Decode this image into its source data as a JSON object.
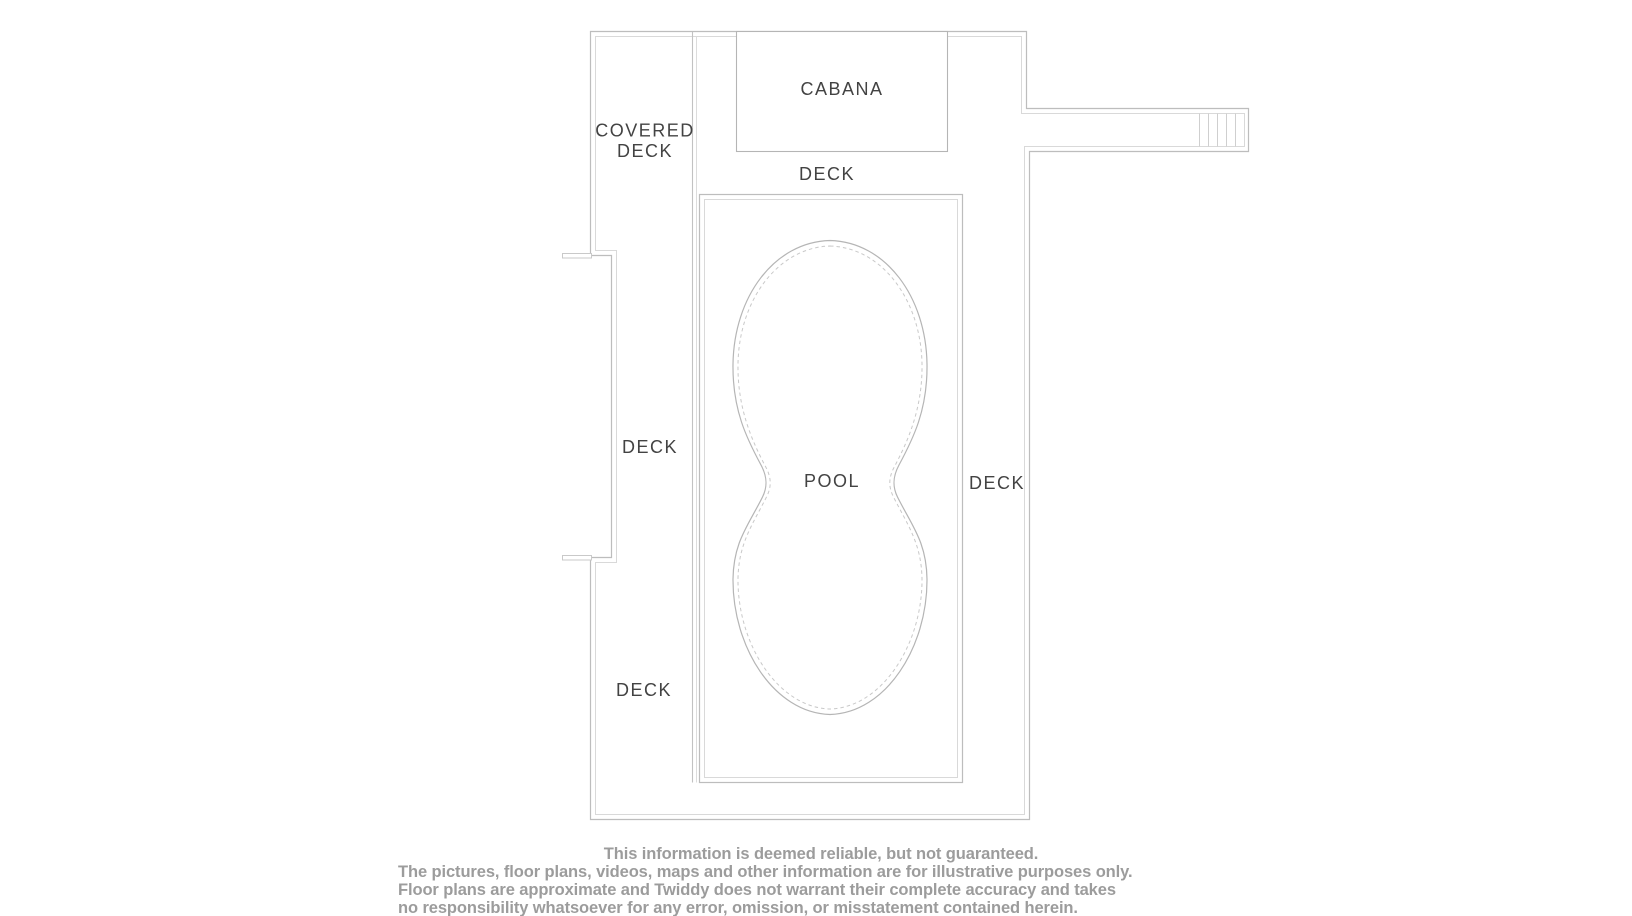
{
  "floor_plan": {
    "labels": {
      "covered_deck_line1": "COVERED",
      "covered_deck_line2": "DECK",
      "cabana": "CABANA",
      "deck_top": "DECK",
      "deck_left_middle": "DECK",
      "deck_left_bottom": "DECK",
      "deck_right": "DECK",
      "pool": "POOL"
    },
    "colors": {
      "wall_line": "#bdbdbd",
      "wall_line_light": "#d9d9d9",
      "pool_line": "#b5b5b5",
      "label_text": "#434343",
      "disclaimer_text": "#9c9c9c",
      "background": "#ffffff"
    }
  },
  "disclaimer": {
    "lines": [
      "This information is deemed reliable, but not guaranteed.",
      "The pictures, floor plans, videos, maps and other information are for illustrative purposes only.",
      "Floor plans are approximate and Twiddy does not warrant their complete accuracy and takes",
      "no responsibility whatsoever for any error, omission, or misstatement contained herein."
    ]
  }
}
